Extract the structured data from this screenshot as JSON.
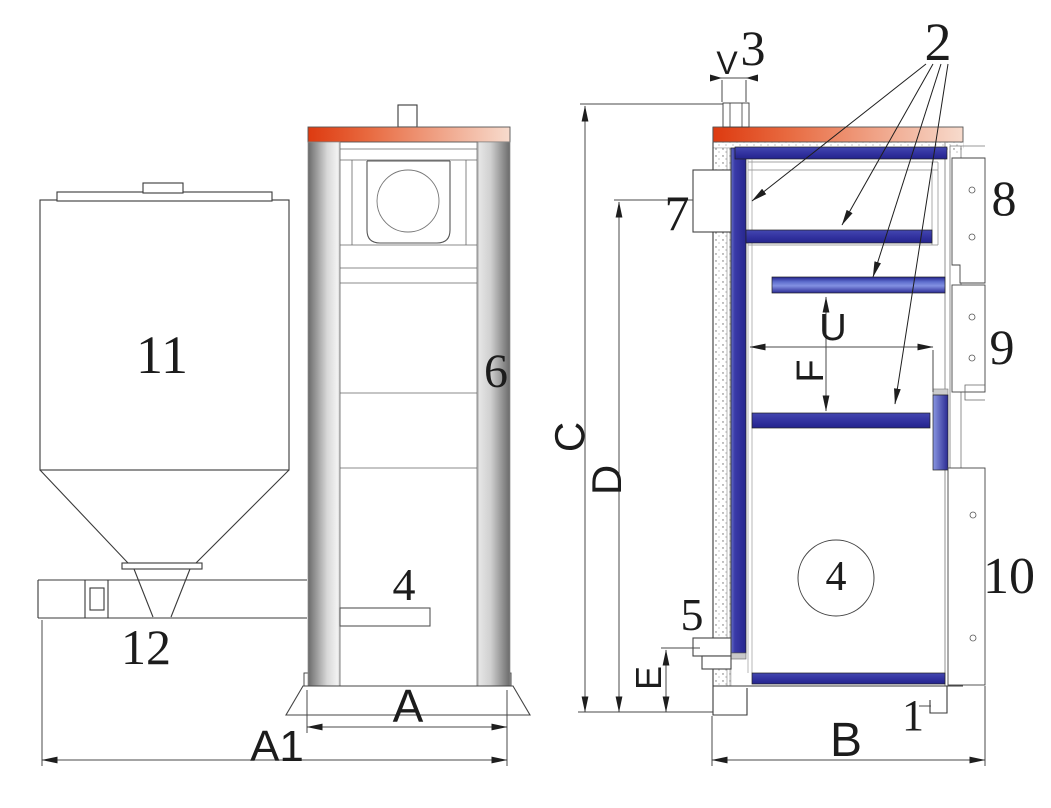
{
  "parts": {
    "p1": "1",
    "p2": "2",
    "p3": "3",
    "p4": "4",
    "p5": "5",
    "p6": "6",
    "p7": "7",
    "p8": "8",
    "p9": "9",
    "p10": "10",
    "p11": "11",
    "p12": "12"
  },
  "dims": {
    "a": "A",
    "a1": "A1",
    "b": "B",
    "c": "C",
    "d": "D",
    "e": "E",
    "f": "F",
    "u": "U",
    "v": "V"
  },
  "colors": {
    "top_plate_red": "#dd3a10",
    "top_plate_red_light": "#f7dbcd",
    "baffle_blue": "#3333a0",
    "baffle_blue_light": "#8391e2",
    "column_gray_dark": "#6a6a6a",
    "column_gray_light": "#f2f2f2",
    "line_color": "#3a3a3a"
  }
}
